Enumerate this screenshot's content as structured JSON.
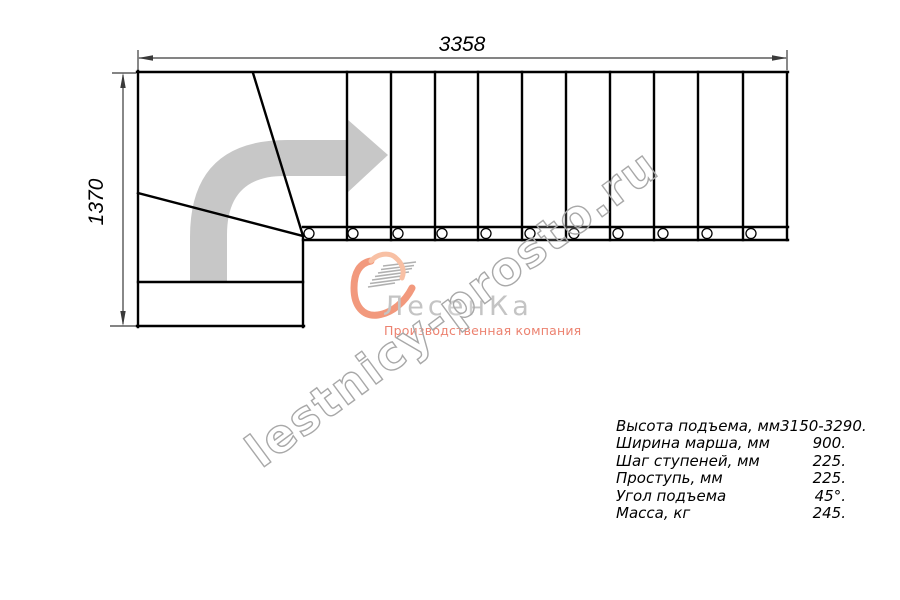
{
  "drawing": {
    "width_dimension": "3358",
    "height_dimension": "1370",
    "line_color": "#000000",
    "arrow_color": "#c7c7c7"
  },
  "watermark": {
    "text": "lestnicy-prosto.ru",
    "color": "#a8a8a8"
  },
  "brand": {
    "name": "ЛесенКа",
    "tagline": "Производственная компания",
    "name_color": "#c4c4c4",
    "accent_color": "#f2997d"
  },
  "specs": {
    "rows": [
      {
        "label": "Высота подъема, мм",
        "value": "3150-3290."
      },
      {
        "label": "Ширина марша, мм",
        "value": "900."
      },
      {
        "label": "Шаг ступеней, мм",
        "value": "225."
      },
      {
        "label": "Проступь, мм",
        "value": "225."
      },
      {
        "label": "Угол подъема",
        "value": "45°."
      },
      {
        "label": "Масса, кг",
        "value": "245."
      }
    ]
  }
}
